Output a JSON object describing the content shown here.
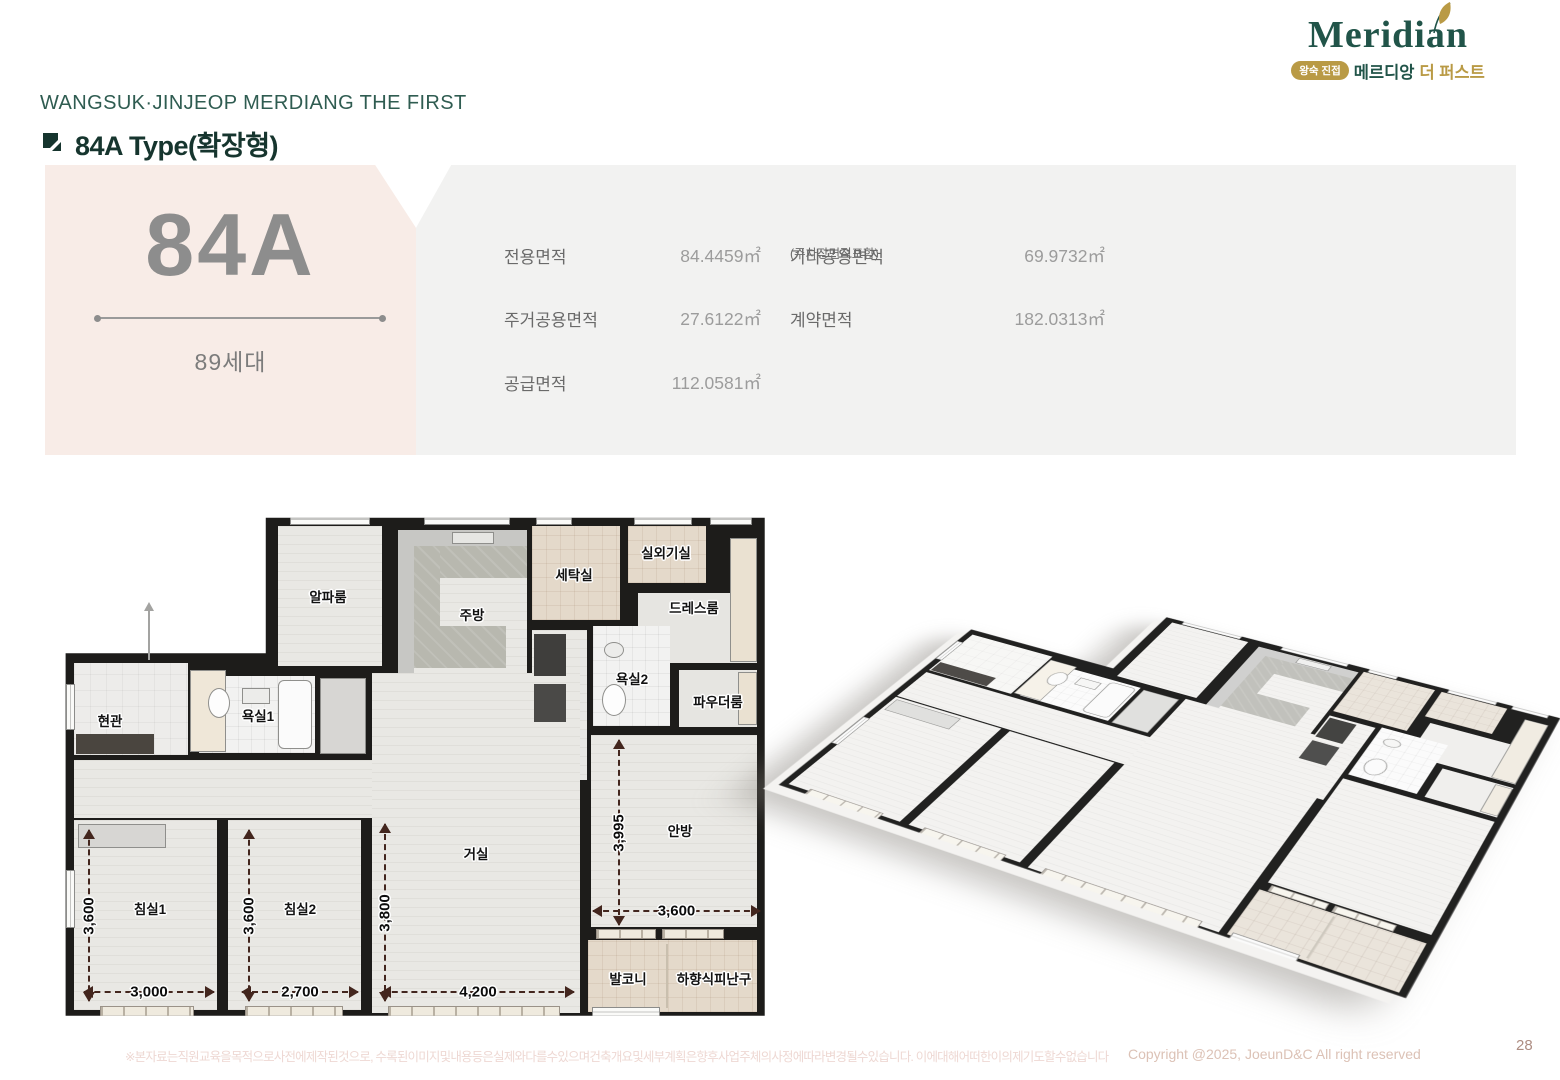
{
  "brand": {
    "logo_text": "Meridian",
    "badge": "왕숙 진접",
    "korean_name": "메르디앙",
    "korean_suffix": "더 퍼스트",
    "green": "#215449",
    "gold": "#b99a45"
  },
  "header": {
    "project": "WANGSUK·JINJEOP MERDIANG THE FIRST",
    "unit_type": "84A Type(확장형)"
  },
  "summary": {
    "type_code": "84A",
    "households": "89세대",
    "rows": [
      [
        {
          "label": "전용면적",
          "sub": "",
          "value": "84.4459㎡"
        },
        {
          "label": "기타공용면적",
          "sub": "(주차장면적포함)",
          "value": "69.9732㎡"
        }
      ],
      [
        {
          "label": "주거공용면적",
          "sub": "",
          "value": "27.6122㎡"
        },
        {
          "label": "계약면적",
          "sub": "",
          "value": "182.0313㎡"
        }
      ],
      [
        {
          "label": "공급면적",
          "sub": "",
          "value": "112.0581㎡"
        }
      ]
    ]
  },
  "floorplan": {
    "w": 720,
    "h": 515,
    "outline": [
      [
        28.3,
        1.9
      ],
      [
        97.6,
        1.9
      ],
      [
        97.6,
        98.6
      ],
      [
        0.5,
        98.6
      ],
      [
        0.5,
        28.2
      ],
      [
        28.3,
        28.2
      ]
    ],
    "rooms": [
      {
        "id": "alpha-room",
        "label": "알파룸",
        "x": 216,
        "y": 18,
        "w": 104,
        "h": 140,
        "fill": "wood",
        "lx": 266,
        "ly": 88
      },
      {
        "id": "kitchen",
        "label": "주방",
        "x": 336,
        "y": 22,
        "w": 129,
        "h": 143,
        "fill": "wood",
        "lx": 410,
        "ly": 106
      },
      {
        "id": "laundry",
        "label": "세탁실",
        "x": 470,
        "y": 18,
        "w": 88,
        "h": 94,
        "fill": "beige",
        "lx": 512,
        "ly": 66
      },
      {
        "id": "outdoor-unit",
        "label": "실외기실",
        "x": 566,
        "y": 18,
        "w": 78,
        "h": 57,
        "fill": "beige",
        "lx": 604,
        "ly": 44
      },
      {
        "id": "dress-room",
        "label": "드레스룸",
        "x": 576,
        "y": 85,
        "w": 119,
        "h": 70,
        "fill": "light",
        "lx": 632,
        "ly": 99
      },
      {
        "id": "bathroom2",
        "label": "욕실2",
        "x": 531,
        "y": 118,
        "w": 77,
        "h": 100,
        "fill": "tile",
        "lx": 570,
        "ly": 170
      },
      {
        "id": "powder-room",
        "label": "파우더룸",
        "x": 617,
        "y": 162,
        "w": 78,
        "h": 57,
        "fill": "light",
        "lx": 656,
        "ly": 193
      },
      {
        "id": "entrance",
        "label": "현관",
        "x": 12,
        "y": 155,
        "w": 114,
        "h": 92,
        "fill": "etile",
        "lx": 48,
        "ly": 212
      },
      {
        "id": "bathroom1",
        "label": "욕실1",
        "x": 137,
        "y": 168,
        "w": 116,
        "h": 77,
        "fill": "tile",
        "lx": 196,
        "ly": 207
      },
      {
        "id": "hallway",
        "label": "",
        "x": 12,
        "y": 252,
        "w": 506,
        "h": 58,
        "fill": "wood",
        "lx": 0,
        "ly": 0
      },
      {
        "id": "passage",
        "label": "",
        "x": 470,
        "y": 122,
        "w": 55,
        "h": 150,
        "fill": "wood",
        "lx": 0,
        "ly": 0
      },
      {
        "id": "living-room",
        "label": "거실",
        "x": 310,
        "y": 165,
        "w": 208,
        "h": 340,
        "fill": "wood",
        "lx": 414,
        "ly": 345
      },
      {
        "id": "master-bedroom",
        "label": "안방",
        "x": 529,
        "y": 227,
        "w": 166,
        "h": 192,
        "fill": "wood",
        "lx": 618,
        "ly": 322
      },
      {
        "id": "bedroom1",
        "label": "침실1",
        "x": 12,
        "y": 312,
        "w": 143,
        "h": 190,
        "fill": "wood",
        "lx": 88,
        "ly": 400
      },
      {
        "id": "bedroom2",
        "label": "침실2",
        "x": 166,
        "y": 312,
        "w": 133,
        "h": 190,
        "fill": "wood",
        "lx": 238,
        "ly": 400
      },
      {
        "id": "balcony",
        "label": "발코니",
        "x": 526,
        "y": 432,
        "w": 80,
        "h": 72,
        "fill": "beige",
        "lx": 566,
        "ly": 470
      },
      {
        "id": "escape-hatch",
        "label": "하향식피난구",
        "x": 606,
        "y": 432,
        "w": 89,
        "h": 72,
        "fill": "beige",
        "lx": 652,
        "ly": 470
      }
    ],
    "details": [
      {
        "x": 336,
        "y": 22,
        "w": 129,
        "h": 16,
        "c": "#c7c7c4"
      },
      {
        "x": 336,
        "y": 38,
        "w": 16,
        "h": 127,
        "c": "#c7c7c4"
      },
      {
        "f": "ktile",
        "x": 352,
        "y": 38,
        "w": 113,
        "h": 32
      },
      {
        "f": "ktile",
        "x": 352,
        "y": 38,
        "w": 26,
        "h": 122
      },
      {
        "f": "ktile",
        "x": 352,
        "y": 118,
        "w": 92,
        "h": 42
      },
      {
        "x": 390,
        "y": 24,
        "w": 42,
        "h": 12,
        "c": "#e6e6e3",
        "b": 1
      },
      {
        "x": 472,
        "y": 126,
        "w": 32,
        "h": 42,
        "c": "#3f3e3c"
      },
      {
        "x": 472,
        "y": 176,
        "w": 32,
        "h": 38,
        "c": "#4a4947"
      },
      {
        "x": 668,
        "y": 30,
        "w": 27,
        "h": 124,
        "c": "#eae1d1",
        "b": 1
      },
      {
        "x": 676,
        "y": 164,
        "w": 19,
        "h": 53,
        "c": "#eae1d1",
        "b": 1
      },
      {
        "x": 16,
        "y": 316,
        "w": 88,
        "h": 24,
        "c": "#d7d6d3",
        "b": 1
      },
      {
        "x": 258,
        "y": 170,
        "w": 46,
        "h": 76,
        "c": "#d7d6d3",
        "b": 1
      },
      {
        "x": 14,
        "y": 226,
        "w": 78,
        "h": 20,
        "c": "#4a453f"
      },
      {
        "x": 128,
        "y": 162,
        "w": 36,
        "h": 82,
        "c": "#efe7d8",
        "b": 1
      },
      {
        "x": 216,
        "y": 172,
        "w": 34,
        "h": 69,
        "c": "#fbfbfb",
        "b": 1,
        "r": 6
      },
      {
        "e": 1,
        "x": 146,
        "y": 180,
        "w": 22,
        "h": 30,
        "c": "#fdfdfd",
        "b": 1
      },
      {
        "x": 180,
        "y": 180,
        "w": 28,
        "h": 16,
        "c": "#ececea",
        "b": 1
      },
      {
        "e": 1,
        "x": 540,
        "y": 176,
        "w": 24,
        "h": 32,
        "c": "#fdfdfd",
        "b": 1
      },
      {
        "e": 1,
        "x": 542,
        "y": 134,
        "w": 20,
        "h": 16,
        "c": "#ececea",
        "b": 1
      },
      {
        "x": 604,
        "y": 436,
        "w": 2,
        "h": 64,
        "c": "#c9bfae"
      }
    ],
    "windows": [
      {
        "t": "win",
        "x": 228,
        "y": 5,
        "w": 80,
        "h": 12
      },
      {
        "t": "win",
        "x": 362,
        "y": 5,
        "w": 86,
        "h": 12
      },
      {
        "t": "win",
        "x": 474,
        "y": 5,
        "w": 36,
        "h": 12
      },
      {
        "t": "win",
        "x": 572,
        "y": 5,
        "w": 58,
        "h": 12
      },
      {
        "t": "win",
        "x": 648,
        "y": 5,
        "w": 42,
        "h": 12
      },
      {
        "t": "rail",
        "x": 38,
        "y": 498,
        "w": 94,
        "h": 11
      },
      {
        "t": "rail",
        "x": 183,
        "y": 498,
        "w": 98,
        "h": 11
      },
      {
        "t": "rail",
        "x": 326,
        "y": 498,
        "w": 172,
        "h": 11
      },
      {
        "t": "win",
        "x": 530,
        "y": 499,
        "w": 68,
        "h": 10
      },
      {
        "t": "rail",
        "x": 534,
        "y": 421,
        "w": 60,
        "h": 10
      },
      {
        "t": "rail",
        "x": 600,
        "y": 421,
        "w": 62,
        "h": 10
      },
      {
        "t": "side",
        "x": 4,
        "y": 176,
        "w": 9,
        "h": 46
      },
      {
        "t": "side",
        "x": 4,
        "y": 362,
        "w": 9,
        "h": 58
      }
    ],
    "dims": [
      {
        "d": "v",
        "at": 26,
        "from": 322,
        "to": 493,
        "label": "3,600"
      },
      {
        "d": "v",
        "at": 186,
        "from": 322,
        "to": 493,
        "label": "3,600"
      },
      {
        "d": "v",
        "at": 322,
        "from": 316,
        "to": 493,
        "label": "3,800"
      },
      {
        "d": "v",
        "at": 556,
        "from": 232,
        "to": 417,
        "label": "3,995"
      },
      {
        "d": "h",
        "at": 483,
        "from": 22,
        "to": 152,
        "label": "3,000"
      },
      {
        "d": "h",
        "at": 483,
        "from": 180,
        "to": 296,
        "label": "2,700"
      },
      {
        "d": "h",
        "at": 483,
        "from": 320,
        "to": 512,
        "label": "4,200"
      },
      {
        "d": "h",
        "at": 402,
        "from": 531,
        "to": 698,
        "label": "3,600"
      }
    ],
    "entry_arrow": {
      "x": 86,
      "from": 96,
      "to": 152
    }
  },
  "footer": {
    "disclaimer": "※본자료는직원교육을목적으로사전에제작된것으로, 수록된이미지및내용등은실제와다를수있으며건축개요및세부계획은향후사업주체의사정에따라변경될수있습니다. 이에대해어떠한이의제기도할수없습니다",
    "copyright": "Copyright @2025, JoeunD&C All right reserved",
    "page_number": "28"
  }
}
